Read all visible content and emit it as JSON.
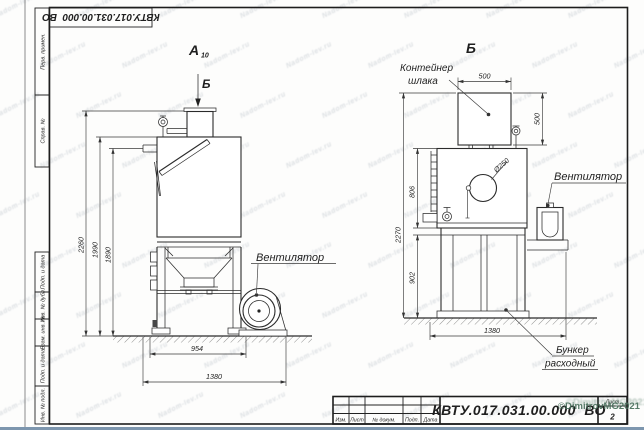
{
  "colors": {
    "line": "#2b2b2b",
    "scan_strip": "#7d96ae",
    "copyright_green": "#49705c",
    "watermark_gray": "#c6ccd2"
  },
  "watermarks": {
    "tile": "Nadom-lev.ru",
    "copyright": "©DimitrovMG2021"
  },
  "frame": {
    "stamp": "КВТУ.017.031.00.000  ВО",
    "side_column": [
      "Перв. примен.",
      "Справ. №",
      "Подп. и дата",
      "Инв. № дубл.",
      "Взам. инв. №",
      "Подп. и дата",
      "Инв. № подл."
    ],
    "title_block": {
      "designation": "КВТУ.017.031.00.000  ВО",
      "labels": [
        "Изм.",
        "Лист",
        "№ докум.",
        "Подп.",
        "Дата"
      ],
      "sheet_label": "Лист",
      "sheet_number": "2"
    }
  },
  "drawing": {
    "view_a": {
      "label": "А",
      "label_sub": "10",
      "arrow_label": "Б",
      "dims": {
        "total_height": "2260",
        "body_height": "1990",
        "pipe_height": "1890",
        "frame_width": "954",
        "total_width": "1380"
      },
      "callout_fan": "Вентилятор"
    },
    "view_b": {
      "label": "Б",
      "dims": {
        "container_width": "500",
        "container_height": "500",
        "total_height": "2270",
        "body_height": "806",
        "frame_height": "902",
        "total_width": "1380",
        "hole_diameter": "Ø250"
      },
      "callouts": {
        "container_line1": "Контейнер",
        "container_line2": "шлака",
        "fan": "Вентилятор",
        "hopper_line1": "Бункер",
        "hopper_line2": "расходный"
      }
    }
  }
}
